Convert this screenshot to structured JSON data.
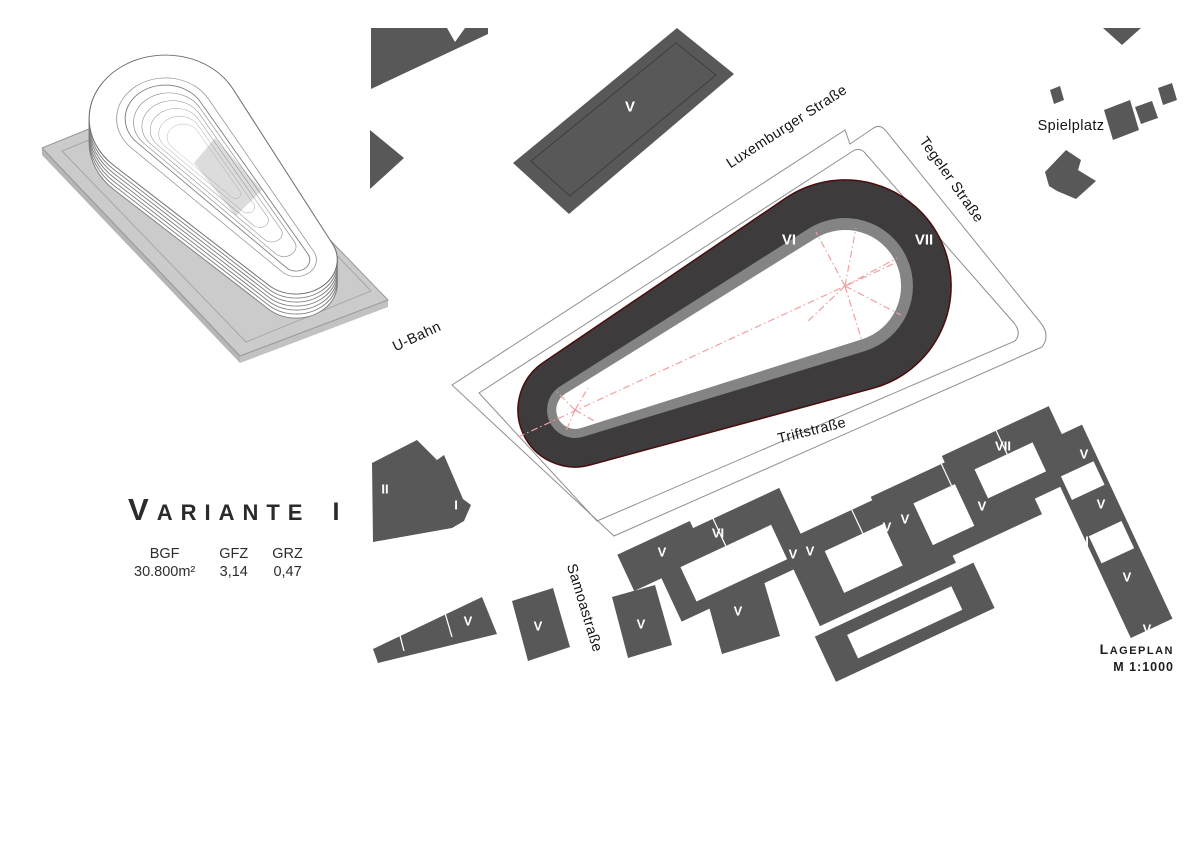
{
  "title": {
    "lead": "V",
    "rest": "ARIANTE",
    "numeral": "I",
    "full": "Variante I"
  },
  "stats": {
    "columns": [
      {
        "label": "BGF",
        "value": "30.800m²"
      },
      {
        "label": "GFZ",
        "value": "3,14"
      },
      {
        "label": "GRZ",
        "value": "0,47"
      }
    ]
  },
  "legend": {
    "lead": "L",
    "rest": "AGEPLAN",
    "full": "Lageplan",
    "scale": "M 1:1000"
  },
  "colors": {
    "block_gray": "#585858",
    "ring_dark": "#3d3b3c",
    "ring_outline": "#4a0e0e",
    "inner_band_gray": "#848484",
    "axis_red": "#f0a0a0",
    "boundary_line": "#8f8f8f",
    "plate_gray": "#cbcbcb"
  },
  "plan": {
    "street_labels": [
      {
        "text": "Luxemburger Straße",
        "x": 787,
        "y": 127,
        "rot": -33
      },
      {
        "text": "Tegeler Straße",
        "x": 951,
        "y": 180,
        "rot": 55
      },
      {
        "text": "Triftstraße",
        "x": 812,
        "y": 431,
        "rot": -14
      },
      {
        "text": "Samoastraße",
        "x": 584,
        "y": 608,
        "rot": 73
      },
      {
        "text": "U-Bahn",
        "x": 417,
        "y": 337,
        "rot": -25
      },
      {
        "text": "Spielplatz",
        "x": 1071,
        "y": 126,
        "rot": 0
      }
    ],
    "building_labels": [
      {
        "text": "VI",
        "x": 789,
        "y": 240,
        "size": 15
      },
      {
        "text": "VII",
        "x": 924,
        "y": 240,
        "size": 15
      },
      {
        "text": "V",
        "x": 630,
        "y": 107,
        "size": 15
      },
      {
        "text": "II",
        "x": 385,
        "y": 489,
        "size": 13
      },
      {
        "text": "I",
        "x": 456,
        "y": 505,
        "size": 13
      },
      {
        "text": "V",
        "x": 468,
        "y": 621,
        "size": 13
      },
      {
        "text": "V",
        "x": 538,
        "y": 626,
        "size": 13
      },
      {
        "text": "V",
        "x": 641,
        "y": 624,
        "size": 13
      },
      {
        "text": "V",
        "x": 662,
        "y": 552,
        "size": 13
      },
      {
        "text": "VI",
        "x": 718,
        "y": 533,
        "size": 13
      },
      {
        "text": "V",
        "x": 738,
        "y": 611,
        "size": 13
      },
      {
        "text": "V",
        "x": 793,
        "y": 554,
        "size": 13
      },
      {
        "text": "V",
        "x": 810,
        "y": 551,
        "size": 13
      },
      {
        "text": "V",
        "x": 887,
        "y": 527,
        "size": 13
      },
      {
        "text": "V",
        "x": 905,
        "y": 519,
        "size": 13
      },
      {
        "text": "V",
        "x": 982,
        "y": 506,
        "size": 13
      },
      {
        "text": "VII",
        "x": 1003,
        "y": 446,
        "size": 13
      },
      {
        "text": "I",
        "x": 1036,
        "y": 456,
        "size": 13
      },
      {
        "text": "V",
        "x": 1084,
        "y": 454,
        "size": 13
      },
      {
        "text": "V",
        "x": 1101,
        "y": 504,
        "size": 13
      },
      {
        "text": "I",
        "x": 1087,
        "y": 541,
        "size": 13
      },
      {
        "text": "V",
        "x": 1127,
        "y": 577,
        "size": 13
      },
      {
        "text": "V",
        "x": 1147,
        "y": 629,
        "size": 13
      }
    ]
  }
}
